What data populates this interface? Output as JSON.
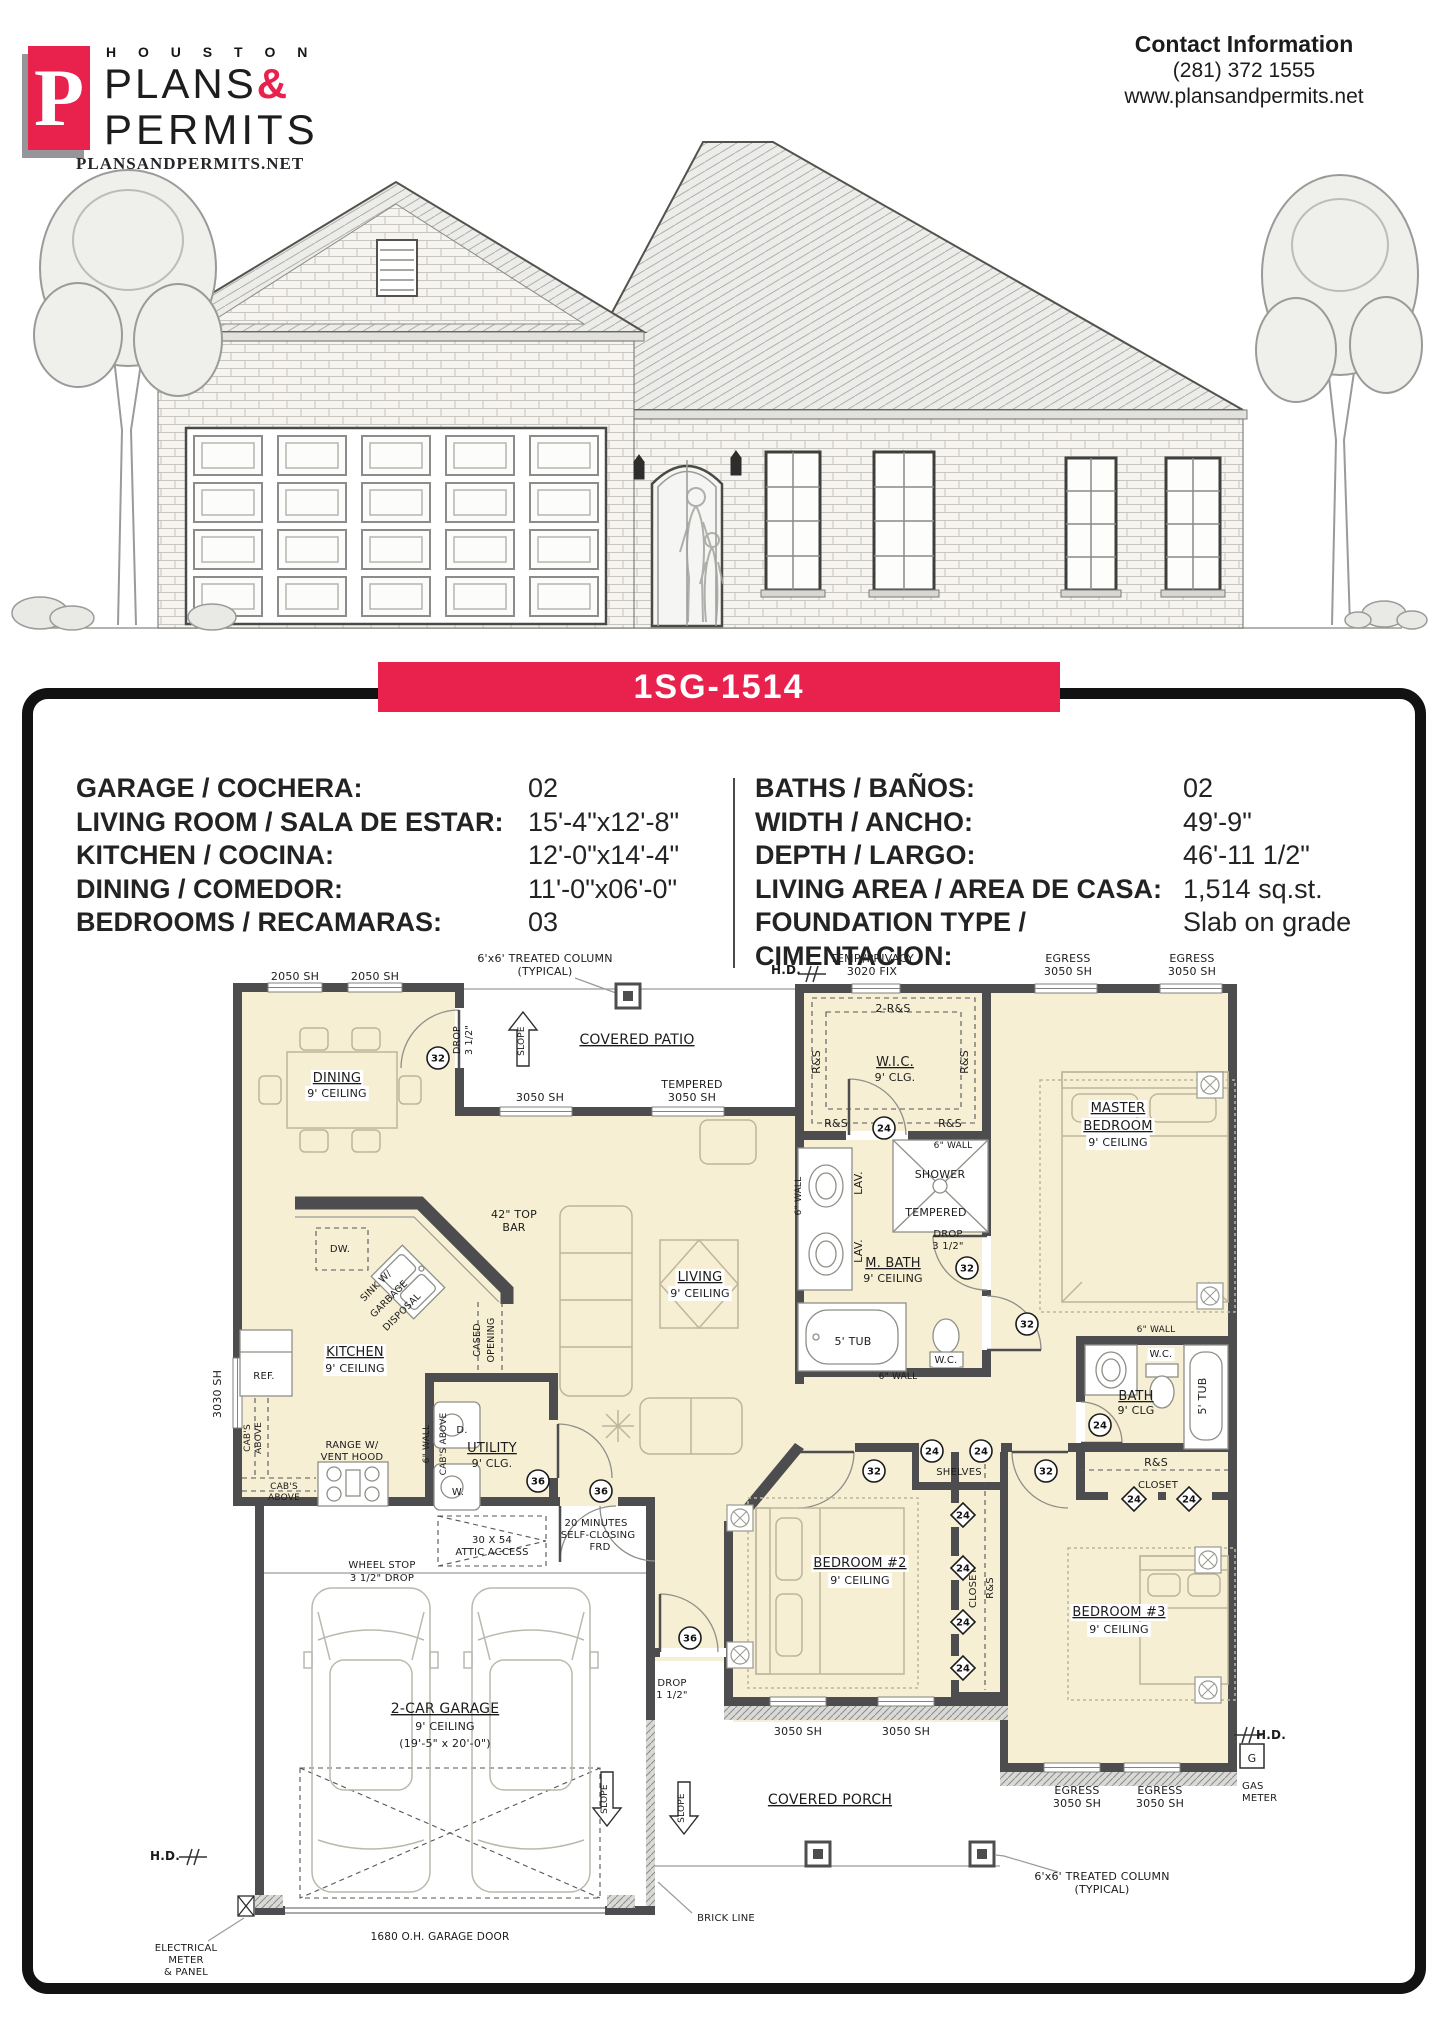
{
  "header": {
    "logo": {
      "mark": "P",
      "houston": "H O U S T O N",
      "plans": "PLANS",
      "ampersand": "&",
      "permits": "PERMITS",
      "website": "PLANSANDPERMITS.NET"
    },
    "contact": {
      "title": "Contact Information",
      "phone": "(281) 372 1555",
      "website": "www.plansandpermits.net"
    }
  },
  "banner": {
    "plan_id": "1SG-1514"
  },
  "colors": {
    "brand_red": "#E8224D",
    "cream": "#F6EFD4",
    "wall": "#4D4D4F"
  },
  "specs": {
    "left": [
      {
        "label": "GARAGE / COCHERA:",
        "value": "02"
      },
      {
        "label": "LIVING ROOM / SALA DE ESTAR:",
        "value": "15'-4\"x12'-8\""
      },
      {
        "label": "KITCHEN / COCINA:",
        "value": "12'-0\"x14'-4\""
      },
      {
        "label": "DINING / COMEDOR:",
        "value": "11'-0\"x06'-0\""
      },
      {
        "label": "BEDROOMS / RECAMARAS:",
        "value": "03"
      }
    ],
    "right": [
      {
        "label": "BATHS / BAÑOS:",
        "value": "02"
      },
      {
        "label": "WIDTH / ANCHO:",
        "value": "49'-9\""
      },
      {
        "label": "DEPTH / LARGO:",
        "value": "46'-11 1/2\""
      },
      {
        "label": "LIVING AREA / AREA DE CASA:",
        "value": "1,514 sq.st."
      },
      {
        "label": "FOUNDATION TYPE /",
        "value": "Slab on grade"
      },
      {
        "label": "CIMENTACION:",
        "value": ""
      }
    ]
  },
  "floorplan": {
    "labels": [
      {
        "t": "2050 SH",
        "x": 295,
        "y": 980
      },
      {
        "t": "2050 SH",
        "x": 375,
        "y": 980
      },
      {
        "t": "6'x6' TREATED COLUMN",
        "x": 545,
        "y": 962
      },
      {
        "t": "(TYPICAL)",
        "x": 545,
        "y": 975
      },
      {
        "t": "H.D.",
        "x": 786,
        "y": 974,
        "b": 1,
        "s": 12
      },
      {
        "t": "TEMP./PRIVACY",
        "x": 872,
        "y": 962
      },
      {
        "t": "3020 FIX",
        "x": 872,
        "y": 975
      },
      {
        "t": "EGRESS",
        "x": 1068,
        "y": 962
      },
      {
        "t": "3050 SH",
        "x": 1068,
        "y": 975
      },
      {
        "t": "EGRESS",
        "x": 1192,
        "y": 962
      },
      {
        "t": "3050 SH",
        "x": 1192,
        "y": 975
      },
      {
        "t": "COVERED PATIO",
        "x": 637,
        "y": 1044,
        "s": 14,
        "u": 1
      },
      {
        "t": "SLOPE",
        "x": 524,
        "y": 1041,
        "r": -90,
        "s": 9
      },
      {
        "t": "DROP",
        "x": 460,
        "y": 1040,
        "r": -90,
        "s": 9.5
      },
      {
        "t": "3 1/2\"",
        "x": 472,
        "y": 1040,
        "r": -90,
        "s": 9.5
      },
      {
        "t": "DINING",
        "x": 337,
        "y": 1082,
        "s": 13,
        "u": 1,
        "bg": 1
      },
      {
        "t": "9' CEILING",
        "x": 337,
        "y": 1097,
        "bg": 1
      },
      {
        "t": "3050 SH",
        "x": 540,
        "y": 1101
      },
      {
        "t": "TEMPERED",
        "x": 692,
        "y": 1088
      },
      {
        "t": "3050 SH",
        "x": 692,
        "y": 1101
      },
      {
        "t": "2-R&S",
        "x": 893,
        "y": 1012
      },
      {
        "t": "W.I.C.",
        "x": 895,
        "y": 1066,
        "s": 13,
        "u": 1
      },
      {
        "t": "9' CLG.",
        "x": 895,
        "y": 1081
      },
      {
        "t": "R&S",
        "x": 820,
        "y": 1062,
        "r": -90
      },
      {
        "t": "R&S",
        "x": 968,
        "y": 1062,
        "r": -90
      },
      {
        "t": "R&S",
        "x": 836,
        "y": 1127
      },
      {
        "t": "R&S",
        "x": 950,
        "y": 1127
      },
      {
        "t": "6\" WALL",
        "x": 953,
        "y": 1148,
        "s": 9
      },
      {
        "t": "MASTER",
        "x": 1118,
        "y": 1112,
        "s": 13,
        "u": 1,
        "bg": 1
      },
      {
        "t": "BEDROOM",
        "x": 1118,
        "y": 1130,
        "s": 13,
        "u": 1,
        "bg": 1
      },
      {
        "t": "9' CEILING",
        "x": 1118,
        "y": 1146,
        "bg": 1
      },
      {
        "t": "LAV.",
        "x": 862,
        "y": 1183,
        "r": -90
      },
      {
        "t": "LAV.",
        "x": 862,
        "y": 1251,
        "r": -90
      },
      {
        "t": "6\" WALL",
        "x": 801,
        "y": 1196,
        "r": -90,
        "s": 9
      },
      {
        "t": "SHOWER",
        "x": 940,
        "y": 1178
      },
      {
        "t": "TEMPERED",
        "x": 936,
        "y": 1216
      },
      {
        "t": "DROP",
        "x": 948,
        "y": 1237,
        "s": 10
      },
      {
        "t": "3 1/2\"",
        "x": 948,
        "y": 1249,
        "s": 10
      },
      {
        "t": "M. BATH",
        "x": 893,
        "y": 1267,
        "s": 13,
        "u": 1
      },
      {
        "t": "9' CEILING",
        "x": 893,
        "y": 1282
      },
      {
        "t": "5' TUB",
        "x": 853,
        "y": 1345
      },
      {
        "t": "W.C.",
        "x": 946,
        "y": 1363,
        "s": 10,
        "bg": 1
      },
      {
        "t": "6\" WALL",
        "x": 898,
        "y": 1379,
        "s": 9
      },
      {
        "t": "LIVING",
        "x": 700,
        "y": 1281,
        "s": 13,
        "u": 1,
        "bg": 1
      },
      {
        "t": "9' CEILING",
        "x": 700,
        "y": 1297,
        "bg": 1
      },
      {
        "t": "42\" TOP",
        "x": 514,
        "y": 1218
      },
      {
        "t": "BAR",
        "x": 514,
        "y": 1231
      },
      {
        "t": "DW.",
        "x": 340,
        "y": 1252,
        "s": 10
      },
      {
        "t": "SINK W/",
        "x": 378,
        "y": 1288,
        "r": -45,
        "s": 9.5
      },
      {
        "t": "GARBAGE",
        "x": 391,
        "y": 1301,
        "r": -45,
        "s": 9.5
      },
      {
        "t": "DISPOSAL",
        "x": 404,
        "y": 1314,
        "r": -45,
        "s": 9.5
      },
      {
        "t": "KITCHEN",
        "x": 355,
        "y": 1356,
        "s": 13,
        "u": 1,
        "bg": 1
      },
      {
        "t": "9' CEILING",
        "x": 355,
        "y": 1372,
        "bg": 1
      },
      {
        "t": "REF.",
        "x": 264,
        "y": 1379,
        "s": 10
      },
      {
        "t": "3030 SH",
        "x": 221,
        "y": 1394,
        "r": -90
      },
      {
        "t": "CASED",
        "x": 480,
        "y": 1340,
        "r": -90,
        "s": 9.5
      },
      {
        "t": "OPENING",
        "x": 494,
        "y": 1340,
        "r": -90,
        "s": 9.5
      },
      {
        "t": "CAB'S",
        "x": 250,
        "y": 1438,
        "r": -90,
        "s": 9
      },
      {
        "t": "ABOVE",
        "x": 261,
        "y": 1438,
        "r": -90,
        "s": 9
      },
      {
        "t": "RANGE W/",
        "x": 352,
        "y": 1448,
        "s": 10
      },
      {
        "t": "VENT HOOD",
        "x": 352,
        "y": 1460,
        "s": 10
      },
      {
        "t": "CAB'S",
        "x": 284,
        "y": 1489,
        "s": 9
      },
      {
        "t": "ABOVE",
        "x": 284,
        "y": 1500,
        "s": 9
      },
      {
        "t": "UTILITY",
        "x": 492,
        "y": 1452,
        "s": 13,
        "u": 1
      },
      {
        "t": "9' CLG.",
        "x": 492,
        "y": 1467
      },
      {
        "t": "D.",
        "x": 462,
        "y": 1433,
        "s": 10
      },
      {
        "t": "W.",
        "x": 458,
        "y": 1495,
        "s": 10
      },
      {
        "t": "6\" WALL",
        "x": 429,
        "y": 1444,
        "r": -90,
        "s": 9
      },
      {
        "t": "CAB'S ABOVE",
        "x": 446,
        "y": 1444,
        "r": -90,
        "s": 9
      },
      {
        "t": "20 MINUTES",
        "x": 596,
        "y": 1526,
        "s": 10
      },
      {
        "t": "SELF-CLOSING",
        "x": 598,
        "y": 1538,
        "s": 10
      },
      {
        "t": "FRD",
        "x": 600,
        "y": 1550,
        "s": 10
      },
      {
        "t": "30 X 54",
        "x": 492,
        "y": 1543,
        "s": 10
      },
      {
        "t": "ATTIC ACCESS",
        "x": 492,
        "y": 1555,
        "s": 10
      },
      {
        "t": "WHEEL STOP",
        "x": 382,
        "y": 1568,
        "s": 10
      },
      {
        "t": "3 1/2\" DROP",
        "x": 382,
        "y": 1581,
        "s": 10
      },
      {
        "t": "2-CAR GARAGE",
        "x": 445,
        "y": 1713,
        "s": 14,
        "u": 1
      },
      {
        "t": "9' CEILING",
        "x": 445,
        "y": 1730
      },
      {
        "t": "(19'-5\" x 20'-0\")",
        "x": 445,
        "y": 1747
      },
      {
        "t": "SLOPE",
        "x": 607,
        "y": 1799,
        "r": -90,
        "s": 9
      },
      {
        "t": "DROP",
        "x": 672,
        "y": 1686,
        "s": 10
      },
      {
        "t": "1 1/2\"",
        "x": 672,
        "y": 1698,
        "s": 10
      },
      {
        "t": "BEDROOM #2",
        "x": 860,
        "y": 1567,
        "s": 13,
        "u": 1,
        "bg": 1
      },
      {
        "t": "9' CEILING",
        "x": 860,
        "y": 1584,
        "bg": 1
      },
      {
        "t": "SHELVES",
        "x": 959,
        "y": 1475,
        "s": 10
      },
      {
        "t": "CLOSET",
        "x": 976,
        "y": 1588,
        "r": -90,
        "s": 10
      },
      {
        "t": "R&S",
        "x": 993,
        "y": 1588,
        "r": -90,
        "s": 10
      },
      {
        "t": "3050 SH",
        "x": 798,
        "y": 1735
      },
      {
        "t": "3050 SH",
        "x": 906,
        "y": 1735
      },
      {
        "t": "6\" WALL",
        "x": 1156,
        "y": 1332,
        "s": 9
      },
      {
        "t": "W.C.",
        "x": 1161,
        "y": 1357,
        "s": 10,
        "bg": 1
      },
      {
        "t": "BATH",
        "x": 1136,
        "y": 1400,
        "s": 13,
        "u": 1
      },
      {
        "t": "9' CLG",
        "x": 1136,
        "y": 1414
      },
      {
        "t": "5' TUB",
        "x": 1206,
        "y": 1396,
        "r": -90
      },
      {
        "t": "R&S",
        "x": 1156,
        "y": 1466
      },
      {
        "t": "CLOSET",
        "x": 1158,
        "y": 1488,
        "s": 10
      },
      {
        "t": "BEDROOM #3",
        "x": 1119,
        "y": 1616,
        "s": 13,
        "u": 1,
        "bg": 1
      },
      {
        "t": "9' CEILING",
        "x": 1119,
        "y": 1633,
        "bg": 1
      },
      {
        "t": "EGRESS",
        "x": 1077,
        "y": 1794
      },
      {
        "t": "3050 SH",
        "x": 1077,
        "y": 1807
      },
      {
        "t": "EGRESS",
        "x": 1160,
        "y": 1794
      },
      {
        "t": "3050 SH",
        "x": 1160,
        "y": 1807
      },
      {
        "t": "COVERED PORCH",
        "x": 830,
        "y": 1804,
        "s": 14,
        "u": 1
      },
      {
        "t": "SLOPE",
        "x": 684,
        "y": 1808,
        "r": -90,
        "s": 9
      },
      {
        "t": "BRICK LINE",
        "x": 726,
        "y": 1921,
        "s": 10
      },
      {
        "t": "1680 O.H. GARAGE DOOR",
        "x": 440,
        "y": 1940,
        "s": 10.5
      },
      {
        "t": "ELECTRICAL",
        "x": 186,
        "y": 1951,
        "s": 10
      },
      {
        "t": "METER",
        "x": 186,
        "y": 1963,
        "s": 10
      },
      {
        "t": "& PANEL",
        "x": 186,
        "y": 1975,
        "s": 10
      },
      {
        "t": "H.D.",
        "x": 165,
        "y": 1860,
        "b": 1,
        "s": 12
      },
      {
        "t": "H.D.",
        "x": 1271,
        "y": 1739,
        "b": 1,
        "s": 12
      },
      {
        "t": "G",
        "x": 1252,
        "y": 1762,
        "s": 11
      },
      {
        "t": "GAS",
        "x": 1242,
        "y": 1789,
        "s": 10,
        "a": "start"
      },
      {
        "t": "METER",
        "x": 1242,
        "y": 1801,
        "s": 10,
        "a": "start"
      },
      {
        "t": "6'x6' TREATED COLUMN",
        "x": 1102,
        "y": 1880
      },
      {
        "t": "(TYPICAL)",
        "x": 1102,
        "y": 1893
      }
    ],
    "markers": [
      {
        "n": "32",
        "x": 438,
        "y": 1058,
        "shape": "circle"
      },
      {
        "n": "24",
        "x": 884,
        "y": 1128,
        "shape": "circle"
      },
      {
        "n": "32",
        "x": 967,
        "y": 1268,
        "shape": "circle"
      },
      {
        "n": "32",
        "x": 1027,
        "y": 1324,
        "shape": "circle"
      },
      {
        "n": "24",
        "x": 1100,
        "y": 1425,
        "shape": "circle"
      },
      {
        "n": "32",
        "x": 874,
        "y": 1471,
        "shape": "circle"
      },
      {
        "n": "24",
        "x": 932,
        "y": 1451,
        "shape": "circle"
      },
      {
        "n": "24",
        "x": 981,
        "y": 1451,
        "shape": "circle"
      },
      {
        "n": "32",
        "x": 1046,
        "y": 1471,
        "shape": "circle"
      },
      {
        "n": "36",
        "x": 538,
        "y": 1481,
        "shape": "circle"
      },
      {
        "n": "36",
        "x": 601,
        "y": 1491,
        "shape": "circle"
      },
      {
        "n": "36",
        "x": 690,
        "y": 1638,
        "shape": "circle"
      },
      {
        "n": "24",
        "x": 963,
        "y": 1515,
        "shape": "diamond"
      },
      {
        "n": "24",
        "x": 963,
        "y": 1568,
        "shape": "diamond"
      },
      {
        "n": "24",
        "x": 963,
        "y": 1622,
        "shape": "diamond"
      },
      {
        "n": "24",
        "x": 963,
        "y": 1668,
        "shape": "diamond"
      },
      {
        "n": "24",
        "x": 1134,
        "y": 1499,
        "shape": "diamond"
      },
      {
        "n": "24",
        "x": 1189,
        "y": 1499,
        "shape": "diamond"
      }
    ]
  }
}
